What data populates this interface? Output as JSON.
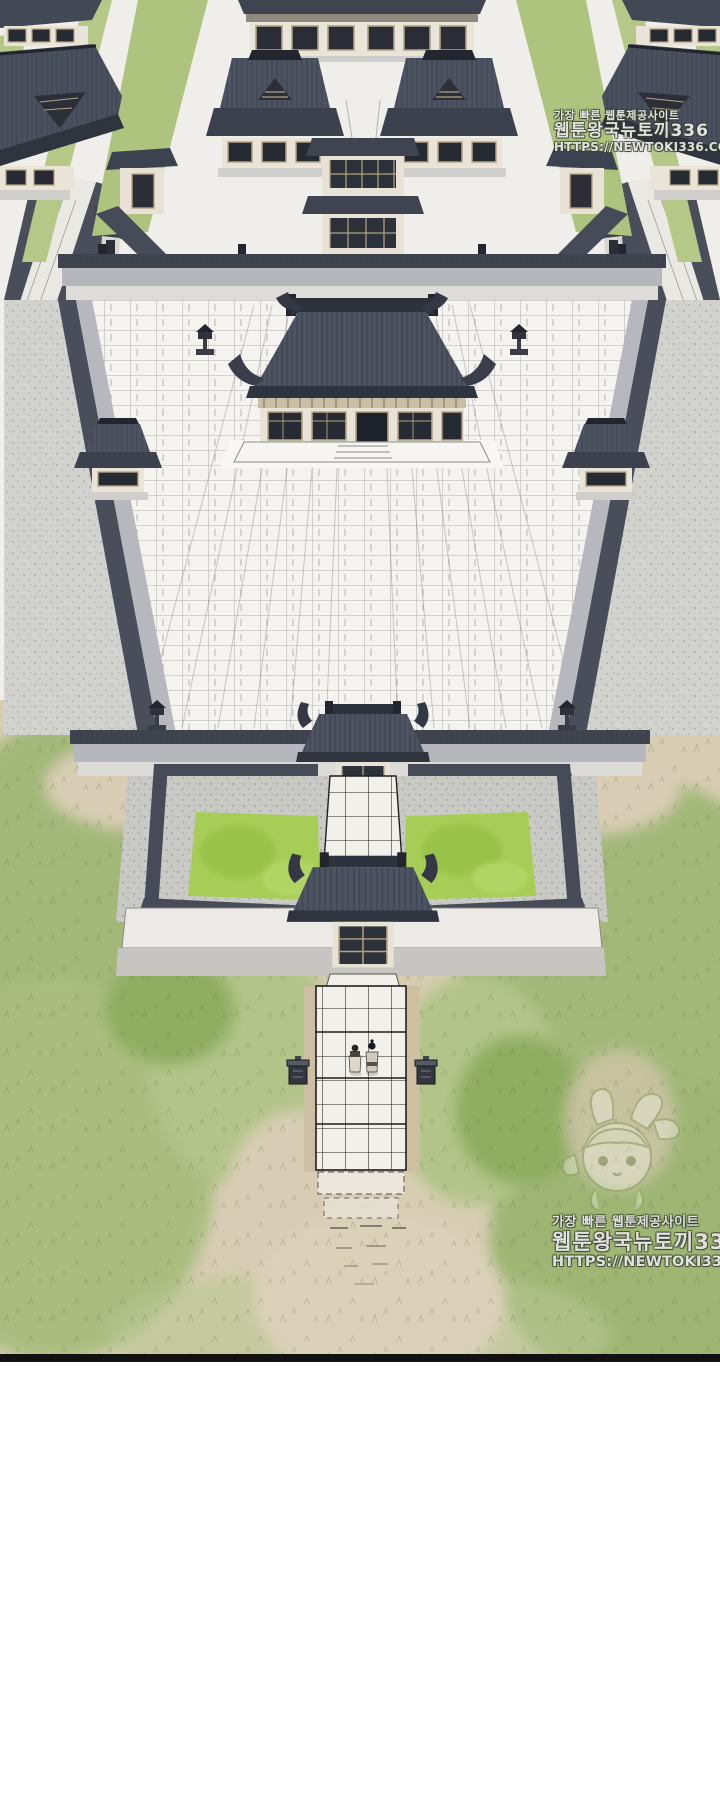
{
  "panel": {
    "alt": "Bird's-eye ink illustration of a symmetric walled palace complex: rear halls and pavilions, a gate tower, a huge white-tiled courtyard with a dark-roofed main hall, corner watchtowers, a middle gate, twin square green gardens flanking a tiled walkway, a front gate and outer wall, and a stone path through grass fields where two tiny figures stand between stone pedestals.",
    "border_color": "#111111",
    "background": "#ffffff"
  },
  "watermarks": {
    "top": {
      "line1": "가장 빠른 웹툰제공사이트",
      "line2": "웹툰왕국뉴토끼336",
      "line3": "HTTPS://NEWTOKI336.COM"
    },
    "bottom": {
      "line1": "가장 빠른 웹툰제공사이트",
      "line2": "웹툰왕국뉴토끼336",
      "line3": "HTTPS://NEWTOKI336.COM",
      "mascot": "bunny-girl-mascot-icon"
    }
  },
  "palette": {
    "roof_dark": "#30343e",
    "roof_mid": "#4e5362",
    "wall_gray": "#b6b7bc",
    "paper": "#f2f1ed",
    "tile_white": "#f4f3ef",
    "garden_green": "#a6cd55",
    "lawn_strip": "#b3c783",
    "grass_green": "#a3b878",
    "sand_tan": "#d7cdb3",
    "ink": "#17181d"
  },
  "scene": {
    "elements": [
      "rear-halls",
      "gate-tower",
      "long-wall",
      "main-hall",
      "tiled-courtyard",
      "corner-towers",
      "middle-gate",
      "twin-gardens",
      "front-gate",
      "front-wall",
      "stone-path",
      "two-figures",
      "stone-pedestals",
      "grass-fields"
    ]
  }
}
